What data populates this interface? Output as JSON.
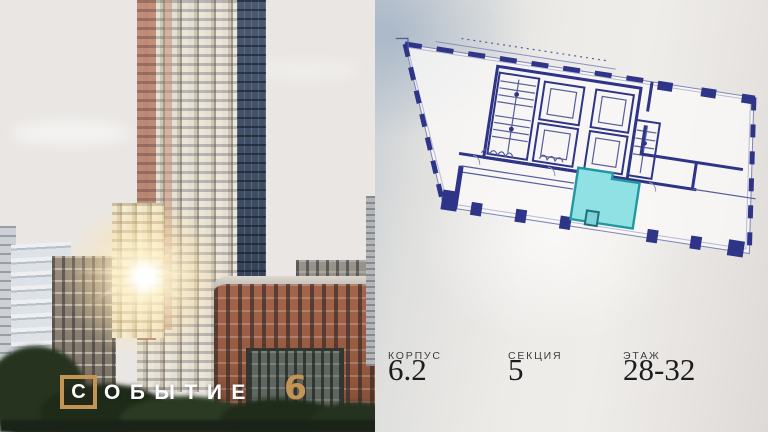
{
  "logo": {
    "boxed_letter": "С",
    "rest_letters": "ОБЫТИЕ",
    "number": "6"
  },
  "unit_details": {
    "items": [
      {
        "label": "КОРПУС",
        "value": "6.2"
      },
      {
        "label": "СЕКЦИЯ",
        "value": "5"
      },
      {
        "label": "ЭТАЖ",
        "value": "28-32"
      }
    ]
  },
  "colors": {
    "accent_gold": "#c49455",
    "plan_line": "#2e3487",
    "unit_highlight_fill": "#8fe1e3",
    "unit_highlight_stroke": "#2496a3"
  }
}
